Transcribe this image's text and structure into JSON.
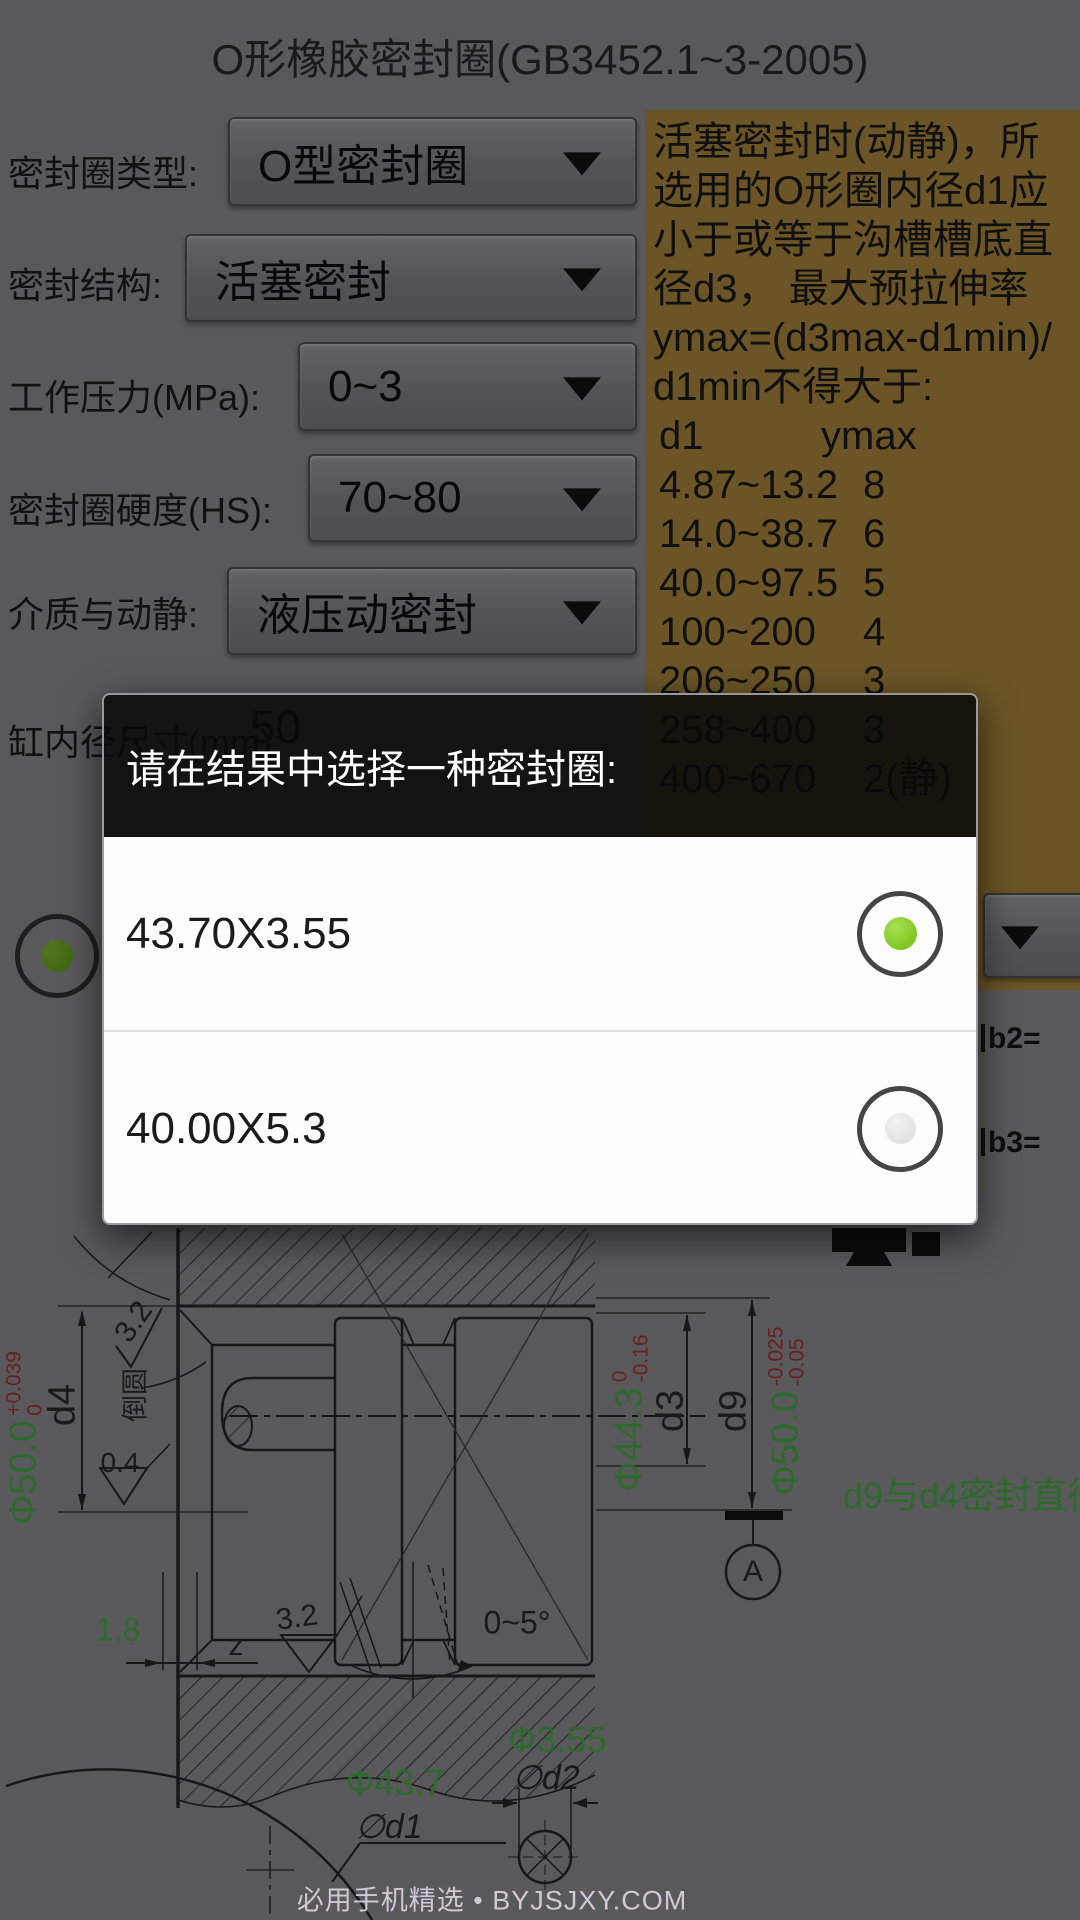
{
  "title": "O形橡胶密封圈(GB3452.1~3-2005)",
  "form": {
    "rows": [
      {
        "label": "密封圈类型:",
        "value": "O型密封圈"
      },
      {
        "label": "密封结构:",
        "value": "活塞密封"
      },
      {
        "label": "工作压力(MPa):",
        "value": "0~3"
      },
      {
        "label": "密封圈硬度(HS):",
        "value": "70~80"
      },
      {
        "label": "介质与动静:",
        "value": "液压动密封"
      },
      {
        "label": "缸内径尺寸(mm):",
        "value": "50"
      }
    ]
  },
  "info_panel": {
    "lines": [
      "活塞密封时(动静)，所",
      "选用的O形圈内径d1应",
      "小于或等于沟槽槽底直",
      "径d3， 最大预拉伸率",
      "ymax=(d3max-d1min)/",
      "d1min不得大于:"
    ],
    "table": {
      "col1": "d1",
      "col2": "ymax",
      "rows": [
        [
          "4.87~13.2",
          "8"
        ],
        [
          "14.0~38.7",
          "6"
        ],
        [
          "40.0~97.5",
          "5"
        ],
        [
          "100~200",
          "4"
        ],
        [
          "206~250",
          "3"
        ],
        [
          "258~400",
          "3"
        ],
        [
          "400~670",
          "2(静)"
        ]
      ]
    }
  },
  "fragments": {
    "b2": "b2=",
    "b3": "b3="
  },
  "dialog": {
    "title": "请在结果中选择一种密封圈:",
    "options": [
      {
        "label": "43.70X3.55",
        "selected": true
      },
      {
        "label": "40.00X5.3",
        "selected": false
      }
    ]
  },
  "drawing": {
    "dims": {
      "d4": {
        "value": "Φ50.0",
        "tol_top": "+0.039",
        "tol_bottom": "0",
        "name": "d4"
      },
      "d3": {
        "value": "Φ44.3",
        "tol_top": "0",
        "tol_bottom": "-0.16",
        "name": "d3"
      },
      "d9": {
        "value": "Φ50.0",
        "tol_top": "-0.025",
        "tol_bottom": "-0.05",
        "name": "d9"
      }
    },
    "labels": {
      "chamfer": "倒圆",
      "rough_top": "3.2",
      "rough_mid": "0.4",
      "depth": "1.8",
      "z": "z",
      "rough_bottom": "3.2",
      "angle": "0~5°",
      "note": "d9与d4密封直径",
      "datum": "A",
      "ring_od": "Φ43.7",
      "ring_od_name": "∅d1",
      "cs_d": "Φ3.55",
      "cs_d_name": "∅d2"
    },
    "watermark": "必用手机精选 • BYJSJXY.COM"
  },
  "colors": {
    "info_panel_bg": "#c39b45",
    "radio_green": "#7cc61f",
    "dim_green": "#4fc24f",
    "tol_red": "#c23a3a"
  }
}
